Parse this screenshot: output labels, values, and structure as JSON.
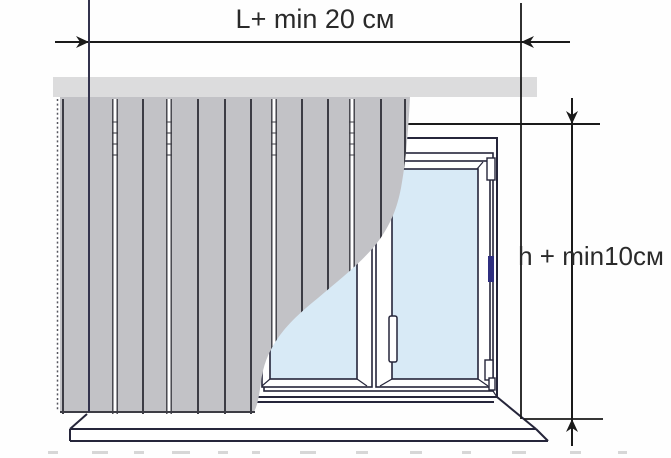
{
  "labels": {
    "width_dimension": "L+ min 20 см",
    "height_dimension": "h + min10см"
  },
  "colors": {
    "background": "#ffffff",
    "blind_slats": "#c2c2c6",
    "slat_lines": "#3c3c44",
    "cornice": "#dcdcdd",
    "glass": "#d8eaf6",
    "frame_outline": "#25253a",
    "dimension_lines": "#1a1a1a",
    "handle_accent": "#2f2f80"
  },
  "diagram": {
    "type": "vertical-blinds-measurement-scheme",
    "parts": [
      "cornice-rail",
      "vertical-blind-vanes",
      "window-frame",
      "window-sashes",
      "window-handle",
      "windowsill",
      "width-dimension-line",
      "height-dimension-line"
    ]
  }
}
